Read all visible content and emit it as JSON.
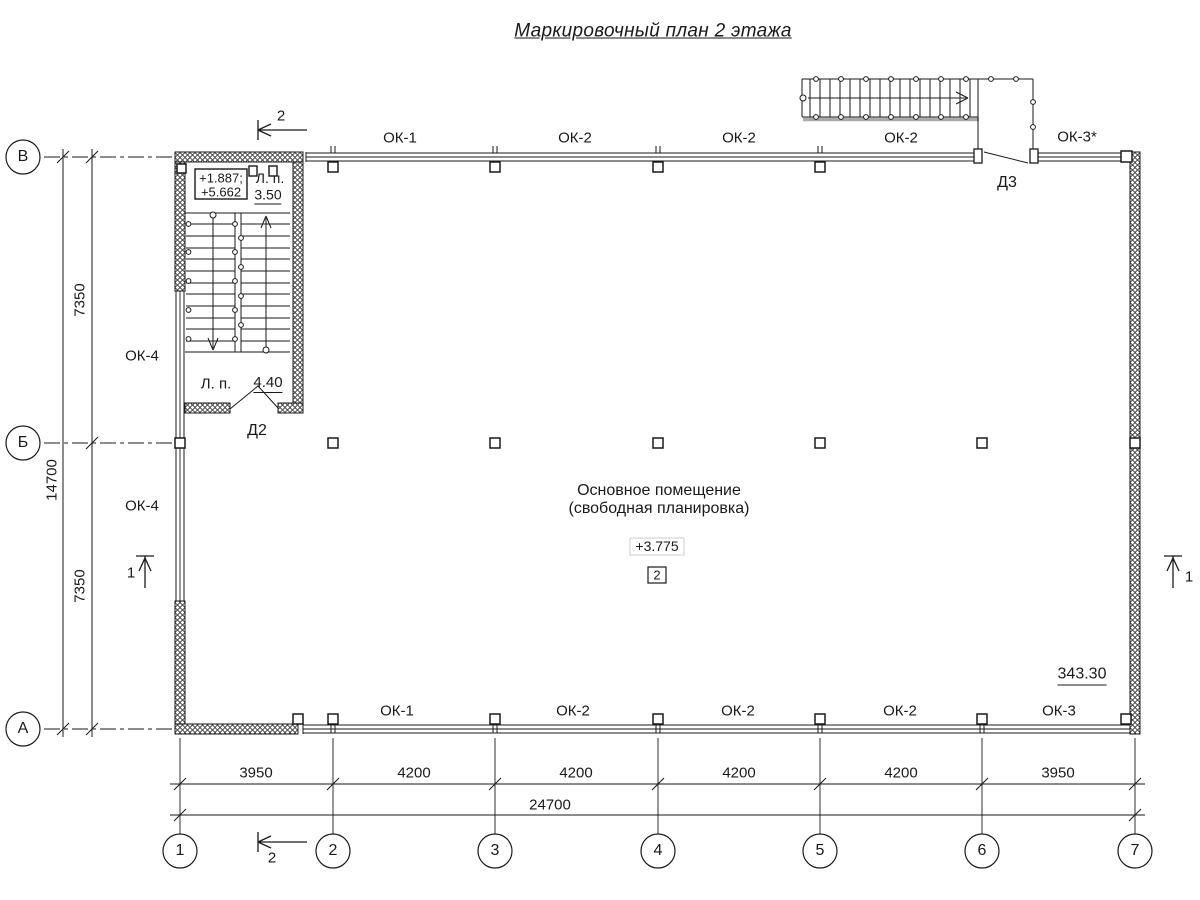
{
  "title": "Маркировочный план 2 этажа",
  "axes": {
    "horizontal": [
      "1",
      "2",
      "3",
      "4",
      "5",
      "6",
      "7"
    ],
    "vertical": [
      "В",
      "Б",
      "А"
    ]
  },
  "dims": {
    "bottom": [
      "3950",
      "4200",
      "4200",
      "4200",
      "4200",
      "3950"
    ],
    "bottom_total": "24700",
    "left": [
      "7350",
      "7350"
    ],
    "left_total": "14700"
  },
  "windows": {
    "top": [
      "ОК-1",
      "ОК-2",
      "ОК-2",
      "ОК-2",
      "ОК-3*"
    ],
    "bottom": [
      "ОК-1",
      "ОК-2",
      "ОК-2",
      "ОК-2",
      "ОК-3"
    ],
    "left": [
      "ОК-4",
      "ОК-4"
    ]
  },
  "doors": {
    "d2": "Д2",
    "d3": "Д3"
  },
  "stair": {
    "elev_line1": "+1.887;",
    "elev_line2": "+5.662",
    "landings": [
      {
        "label": "Л. п.",
        "value": "3.50"
      },
      {
        "label": "Л. п.",
        "value": "4.40"
      }
    ]
  },
  "room": {
    "name_line1": "Основное помещение",
    "name_line2": "(свободная планировка)",
    "elevation": "+3.775",
    "number": "2",
    "area": "343.30"
  },
  "section_marks": {
    "s1": "1",
    "s2": "2"
  },
  "colors": {
    "ink": "#1a1a1a",
    "paper": "#ffffff"
  }
}
